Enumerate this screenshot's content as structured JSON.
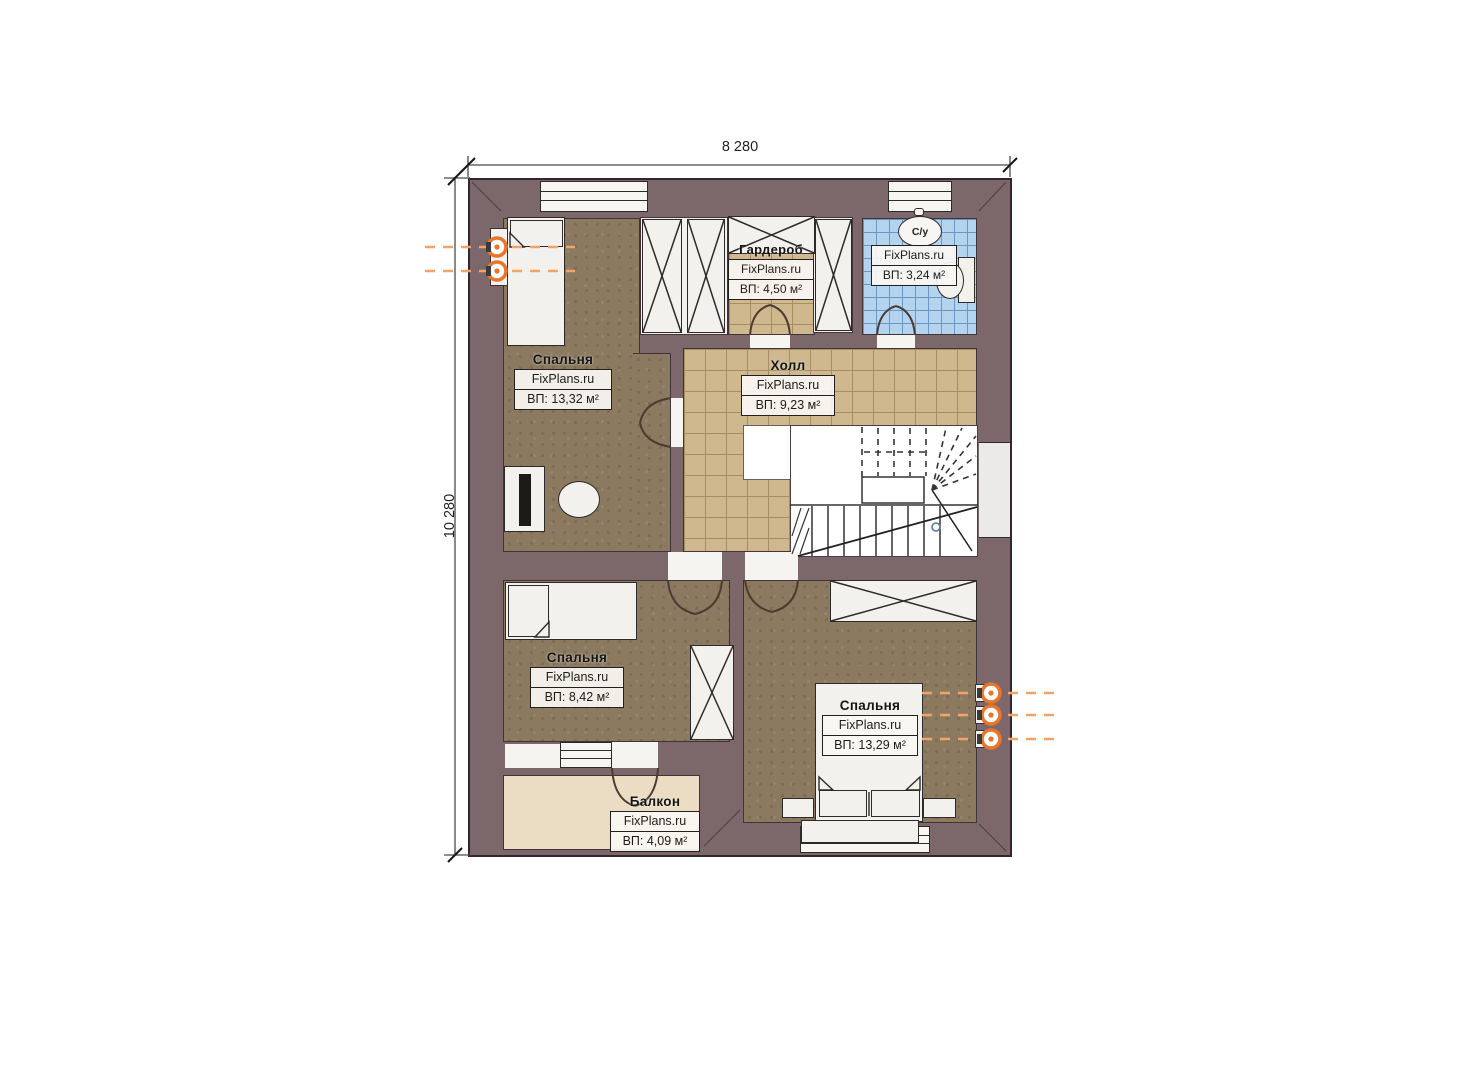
{
  "plan": {
    "title": "second-floor-plan",
    "brand": "FixPlans.ru",
    "dimensions": {
      "width_total": "8 280",
      "height_total": "10 280"
    },
    "rooms": [
      {
        "key": "bedroom-1",
        "name": "Спальня",
        "area": "ВП: 13,32 м²"
      },
      {
        "key": "wardrobe",
        "name": "Гардероб",
        "area": "ВП: 4,50 м²"
      },
      {
        "key": "bathroom",
        "name": "С/у",
        "area": "ВП: 3,24 м²"
      },
      {
        "key": "hall",
        "name": "Холл",
        "area": "ВП: 9,23 м²"
      },
      {
        "key": "bedroom-2",
        "name": "Спальня",
        "area": "ВП: 8,42 м²"
      },
      {
        "key": "bedroom-3",
        "name": "Спальня",
        "area": "ВП: 13,29 м²"
      },
      {
        "key": "balcony",
        "name": "Балкон",
        "area": "ВП: 4,09 м²"
      }
    ],
    "colors": {
      "wall": "#7c676b",
      "wall_outline": "#33272d",
      "bedroom_floor": "#8c7a60",
      "tile_floor": "#cfb78e",
      "tile_grout": "#a68e62",
      "bathroom_floor": "#b4d3ef",
      "bathroom_grout": "#6b97c2",
      "balcony_floor": "#eaddc3",
      "furniture": "#f2f1ed",
      "radiator_orange": "#e8762a",
      "line": "#2e2a2a"
    }
  }
}
